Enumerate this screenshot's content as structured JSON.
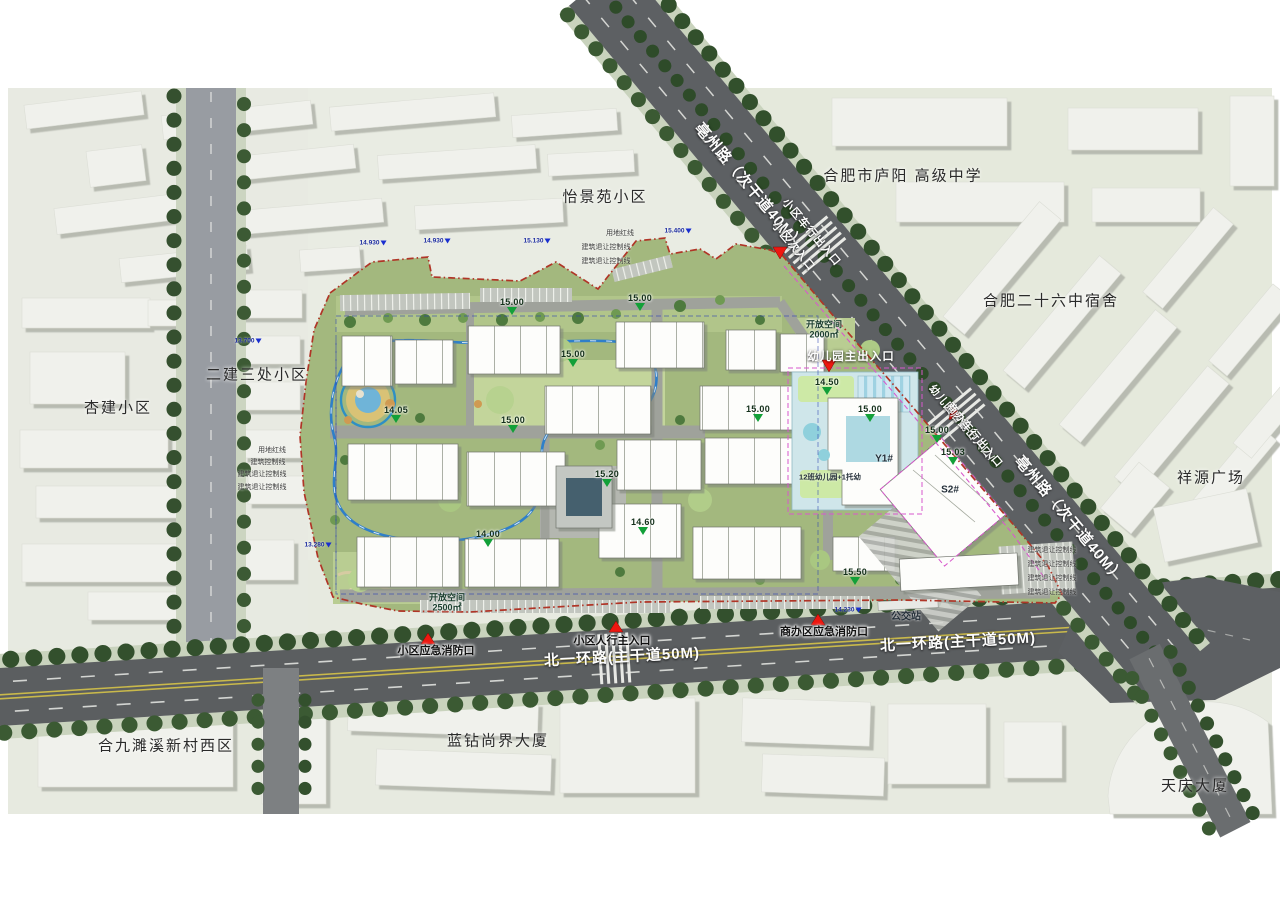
{
  "plan": {
    "surroundings": [
      {
        "label": "怡景苑小区",
        "x": 605,
        "y": 196
      },
      {
        "label": "合肥市庐阳 高级中学",
        "x": 903,
        "y": 175
      },
      {
        "label": "合肥二十六中宿舍",
        "x": 1051,
        "y": 300
      },
      {
        "label": "祥源广场",
        "x": 1211,
        "y": 477
      },
      {
        "label": "二建三处小区",
        "x": 257,
        "y": 374
      },
      {
        "label": "杏建小区",
        "x": 118,
        "y": 407
      },
      {
        "label": "合九濉溪新村西区",
        "x": 166,
        "y": 745
      },
      {
        "label": "蓝钻尚界大厦",
        "x": 498,
        "y": 740
      },
      {
        "label": "天庆大厦",
        "x": 1195,
        "y": 785
      }
    ],
    "road_labels": [
      {
        "label": "亳州路（次干道40M）",
        "x": 750,
        "y": 186,
        "rot": 50,
        "s": 15
      },
      {
        "label": "亳州路（次干道40M）",
        "x": 1070,
        "y": 519,
        "rot": 50,
        "s": 15
      },
      {
        "label": "北一环路(主干道50M)",
        "x": 622,
        "y": 656,
        "rot": -3,
        "s": 15
      },
      {
        "label": "北一环路(主干道50M)",
        "x": 958,
        "y": 641,
        "rot": -3,
        "s": 15
      },
      {
        "label": "小区车行出入口",
        "x": 812,
        "y": 232,
        "rot": 50,
        "s": 11
      },
      {
        "label": "小区次入口",
        "x": 794,
        "y": 246,
        "rot": 50,
        "s": 11
      },
      {
        "label": "幼儿园后勤出入口/",
        "x": 962,
        "y": 423,
        "rot": 50,
        "s": 10.5
      },
      {
        "label": "商办车行出入口",
        "x": 975,
        "y": 435,
        "rot": 50,
        "s": 10.5
      },
      {
        "label": "幼儿园主出入口",
        "x": 851,
        "y": 356,
        "rot": 0,
        "s": 11.5
      }
    ],
    "entrance_labels": [
      {
        "label": "小区人行主入口",
        "x": 612,
        "y": 640
      },
      {
        "label": "小区应急消防口",
        "x": 436,
        "y": 650
      },
      {
        "label": "商办区应急消防口",
        "x": 824,
        "y": 631
      }
    ],
    "site_labels": {
      "open_space_sw_1": "开放空间",
      "open_space_sw_2": "2500㎡",
      "open_space_ne_1": "开放空间",
      "open_space_ne_2": "2000㎡",
      "bus_stop": "公交站",
      "kindergarten": "12班幼儿园+1托幼",
      "building_y1": "Y1#",
      "building_s2": "S2#"
    },
    "elevations": [
      {
        "v": "15.00",
        "x": 512,
        "y": 306
      },
      {
        "v": "15.00",
        "x": 573,
        "y": 358
      },
      {
        "v": "15.00",
        "x": 640,
        "y": 302
      },
      {
        "v": "14.05",
        "x": 396,
        "y": 414
      },
      {
        "v": "15.00",
        "x": 513,
        "y": 424
      },
      {
        "v": "15.20",
        "x": 607,
        "y": 478
      },
      {
        "v": "14.00",
        "x": 488,
        "y": 538
      },
      {
        "v": "14.60",
        "x": 643,
        "y": 526
      },
      {
        "v": "15.00",
        "x": 758,
        "y": 413
      },
      {
        "v": "15.00",
        "x": 870,
        "y": 413
      },
      {
        "v": "15.00",
        "x": 937,
        "y": 434
      },
      {
        "v": "15.03",
        "x": 953,
        "y": 456
      },
      {
        "v": "15.50",
        "x": 855,
        "y": 576
      },
      {
        "v": "14.50",
        "x": 827,
        "y": 386
      }
    ],
    "water_marks": [
      {
        "v": "14.930",
        "x": 373,
        "y": 243
      },
      {
        "v": "14.930",
        "x": 437,
        "y": 241
      },
      {
        "v": "15.130",
        "x": 537,
        "y": 241
      },
      {
        "v": "15.400",
        "x": 678,
        "y": 231
      },
      {
        "v": "13.700",
        "x": 248,
        "y": 341
      },
      {
        "v": "13.280",
        "x": 318,
        "y": 545
      },
      {
        "v": "14.230",
        "x": 848,
        "y": 610
      }
    ],
    "boundary_notes": [
      {
        "t": "用地红线",
        "x": 272,
        "y": 450
      },
      {
        "t": "建筑控制线",
        "x": 268,
        "y": 462
      },
      {
        "t": "建筑退让控制线",
        "x": 262,
        "y": 474
      },
      {
        "t": "建筑退让控制线",
        "x": 262,
        "y": 487
      },
      {
        "t": "用地红线",
        "x": 620,
        "y": 233
      },
      {
        "t": "建筑退让控制线",
        "x": 606,
        "y": 247
      },
      {
        "t": "建筑退让控制线",
        "x": 606,
        "y": 261
      },
      {
        "t": "建筑退让控制线",
        "x": 1052,
        "y": 550
      },
      {
        "t": "建筑退让控制线",
        "x": 1052,
        "y": 564
      },
      {
        "t": "建筑退让控制线",
        "x": 1052,
        "y": 578
      },
      {
        "t": "建筑退让控制线",
        "x": 1052,
        "y": 592
      }
    ],
    "colors": {
      "boundary": "#b03527",
      "track": "#2f7fc9",
      "entrance_marker": "#ee1710",
      "elevation_marker": "#12a038",
      "water_marker": "#1a2fd0",
      "road": "#5d6063"
    }
  }
}
